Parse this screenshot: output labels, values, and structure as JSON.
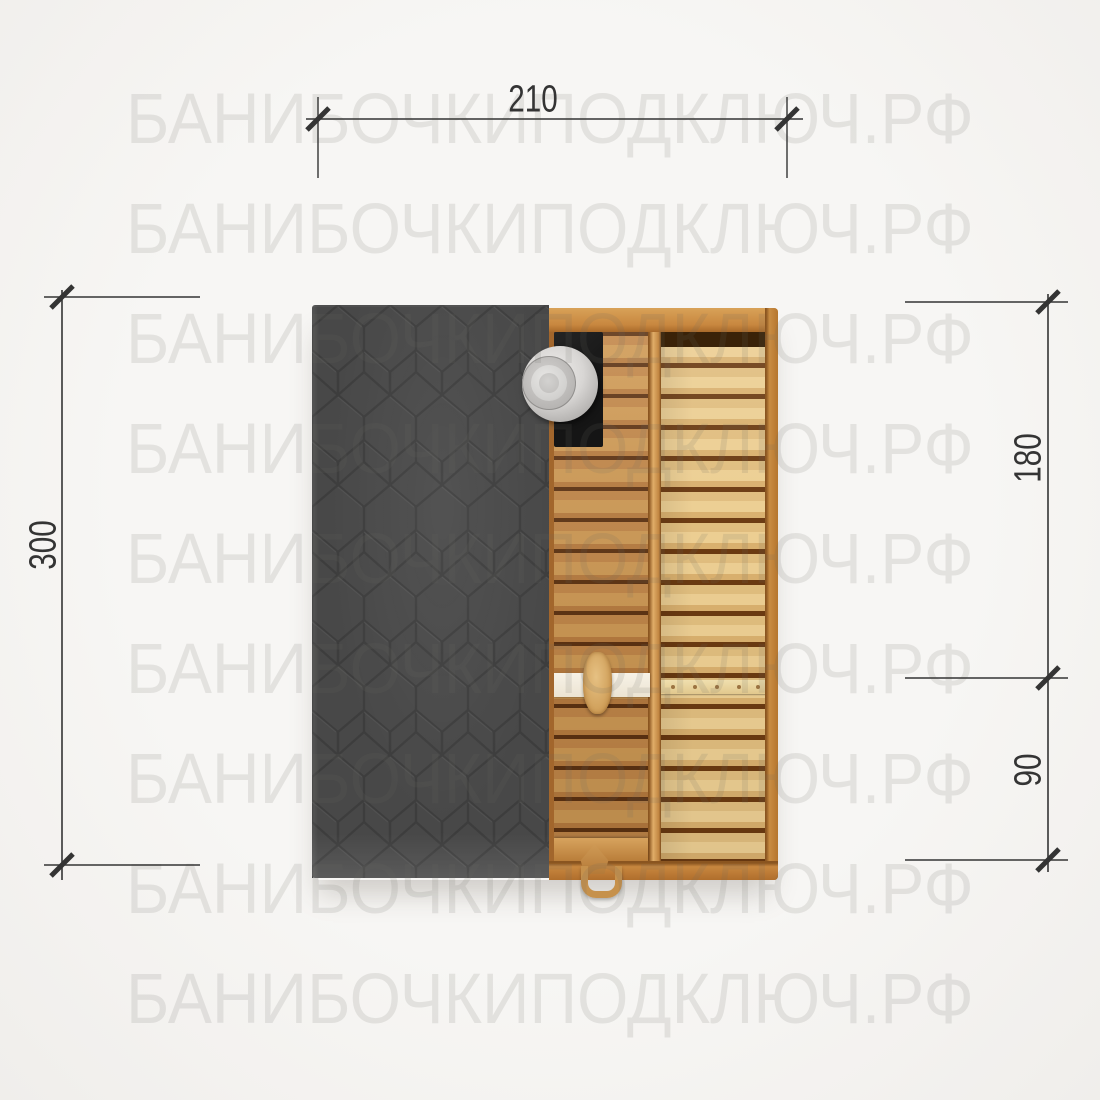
{
  "image": {
    "type": "sauna-top-view-plan",
    "description_visible_objects": "top view plan of a rectangular sauna: dark hex-shingle roof half, wooden interior half with stove, chimney cap, benches and door handle"
  },
  "watermark": {
    "text": "БАНИБОЧКИПОДКЛЮЧ.РФ",
    "repeat_rows": 9
  },
  "dimensions": {
    "top_width": "210",
    "left_height": "300",
    "right_upper": "180",
    "right_lower": "90"
  },
  "colors": {
    "background": "#f5f4f2",
    "watermark_text": "#e2dfdc",
    "roof_dark": "#484848",
    "roof_hex_lines": "#3d3d3d",
    "wood_trim_orange": "#c8873f",
    "wood_plank_medium": "#c28749",
    "wood_plank_light": "#e5c587",
    "plank_gap_dark": "#5e3312",
    "stove_black": "#1a1a1a",
    "chimney_metal": "#d6d5d3",
    "white_band": "#f2ecdf",
    "dimension_line": "#343434"
  }
}
